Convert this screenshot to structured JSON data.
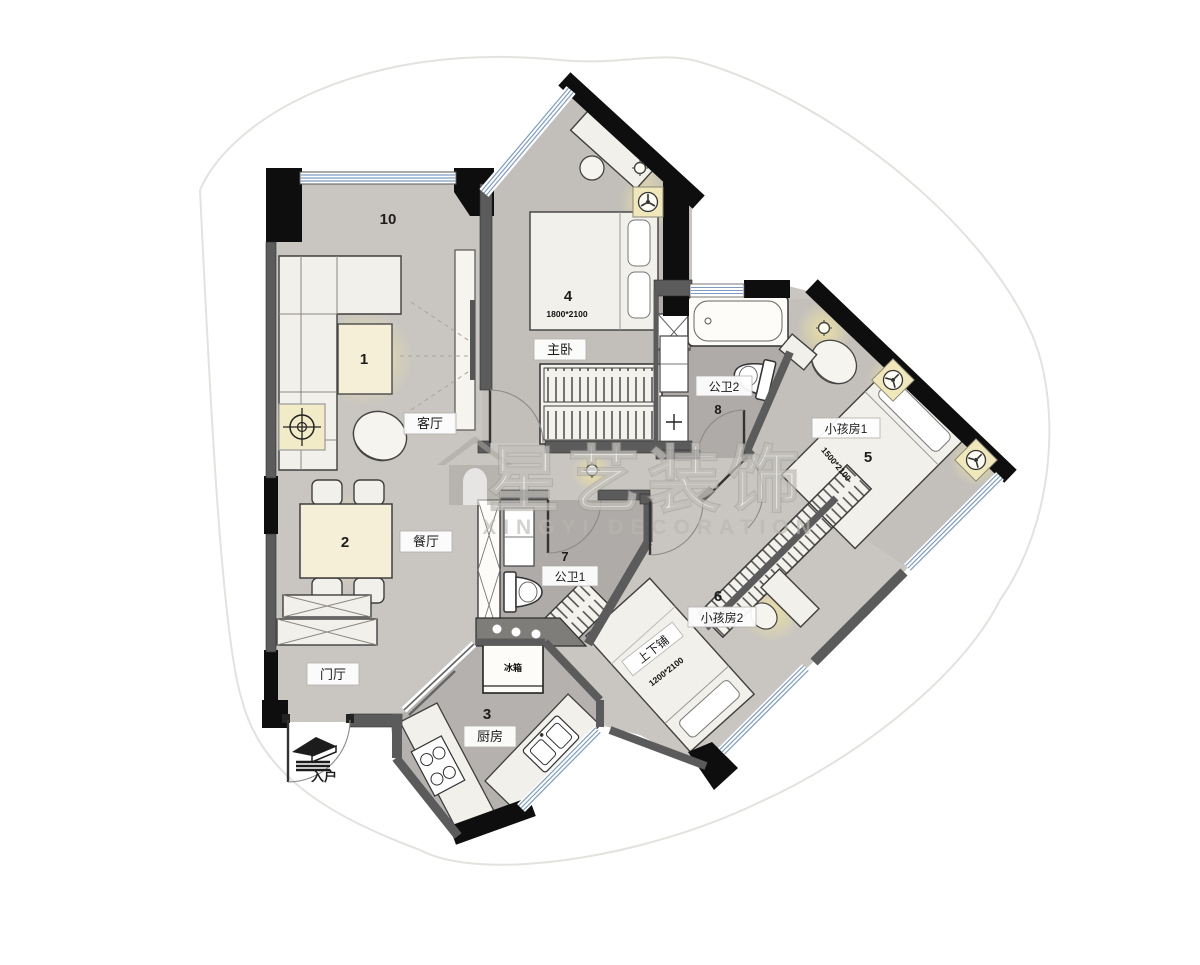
{
  "title": "户型平面布置图",
  "watermark": {
    "title": "星艺装饰",
    "subtitle": "XINGYI DECORATION"
  },
  "labels": {
    "area10": "10",
    "living": {
      "num": "1",
      "name": "客厅"
    },
    "dining": {
      "num": "2",
      "name": "餐厅"
    },
    "hall": {
      "name": "门厅"
    },
    "entry": {
      "name": "入户"
    },
    "kitchen": {
      "num": "3",
      "name": "厨房",
      "fridge": "冰箱"
    },
    "master": {
      "num": "4",
      "name": "主卧",
      "dim": "1800*2100"
    },
    "kids1": {
      "num": "5",
      "name": "小孩房1",
      "dim": "1500*2100"
    },
    "kids2": {
      "num": "6",
      "name": "小孩房2",
      "bunk": "上下铺",
      "dim": "1200*2100"
    },
    "bath1": {
      "num": "7",
      "name": "公卫1"
    },
    "bath2": {
      "num": "8",
      "name": "公卫2"
    }
  },
  "colors": {
    "floor": "#c9c6c1",
    "floor_master": "#c2bfba",
    "floor_wet": "#aeaba8",
    "wall_black": "#0e0e0e",
    "wall_gray": "#5b5b5b",
    "window_blue": "#7d9cc4",
    "furniture": "#f2f0ea",
    "glow": "#efe3a0"
  }
}
